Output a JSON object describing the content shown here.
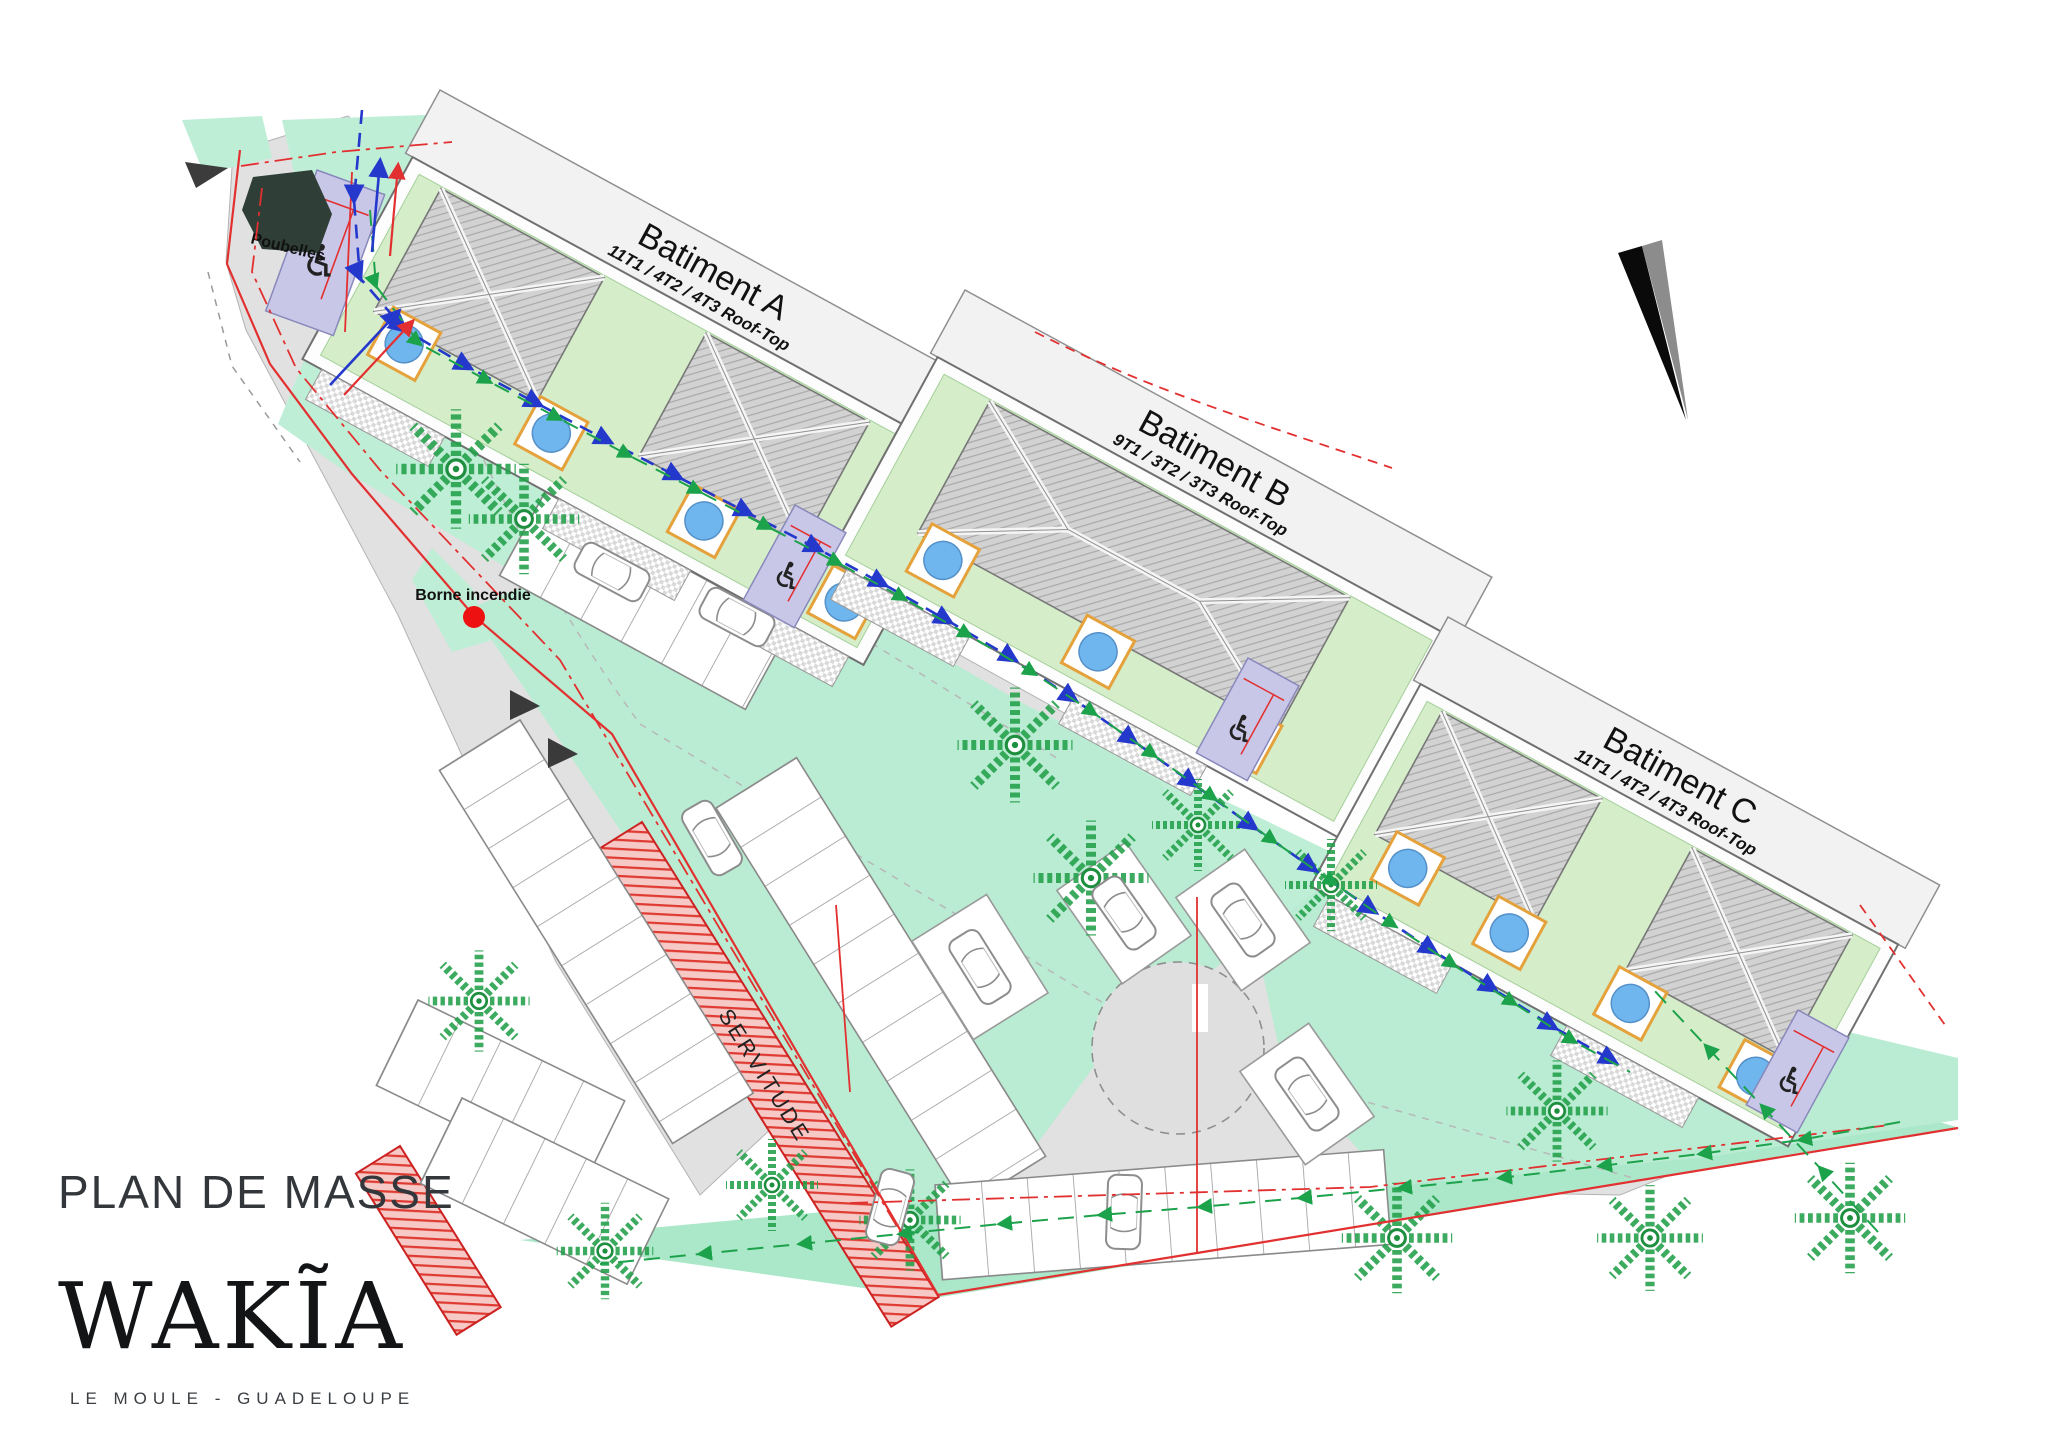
{
  "page": {
    "title": "PLAN DE MASSE",
    "logo": "WAKĨA",
    "location": "LE MOULE - GUADELOUPE"
  },
  "buildings": [
    {
      "id": "A",
      "label": "Batiment A",
      "units": "11T1 / 4T2 / 4T3 Roof-Top"
    },
    {
      "id": "B",
      "label": "Batiment B",
      "units": "9T1 / 3T2 / 3T3 Roof-Top"
    },
    {
      "id": "C",
      "label": "Batiment C",
      "units": "11T1 / 4T2 / 4T3 Roof-Top"
    }
  ],
  "annotations": {
    "poubelles": "Poubelles",
    "borne_incendie": "Borne incendie",
    "servitude": "SERVITUDE"
  },
  "icons": {
    "wheelchair": "♿"
  },
  "colors": {
    "mint": "#bfeed6",
    "mint_dark": "#abe8c9",
    "courtyard": "#d5eec9",
    "road_gray": "#e1e1e1",
    "lavender": "#c9c7e8",
    "pool_blue": "#6fb6ee",
    "pool_border": "#e5a23c",
    "boundary_red": "#e23030",
    "utility_blue": "#2438cc",
    "utility_green": "#1da24c",
    "roof_gray": "#d2d2d2",
    "trash_dark": "#2f3e37",
    "tree_green": "#23a04a"
  }
}
